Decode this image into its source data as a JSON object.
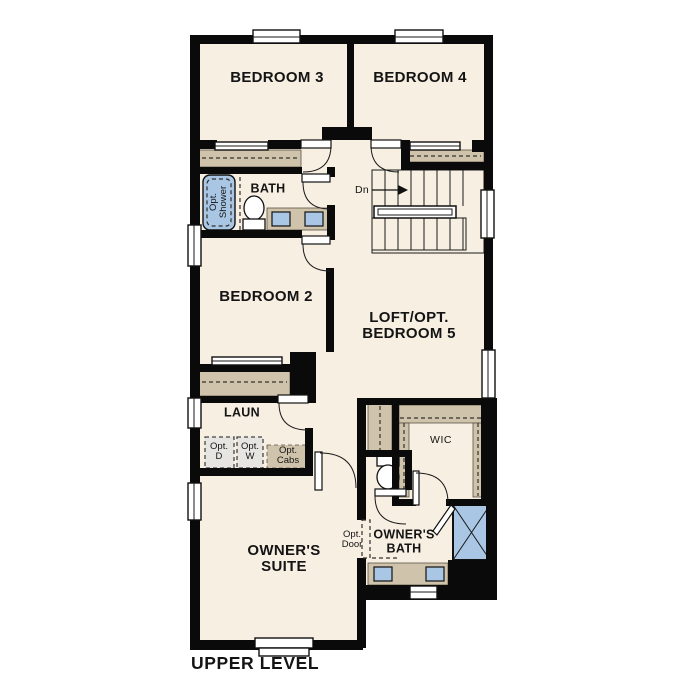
{
  "plan": {
    "level_label": "UPPER LEVEL",
    "rooms": {
      "bedroom3": {
        "label": "BEDROOM 3"
      },
      "bedroom4": {
        "label": "BEDROOM 4"
      },
      "bedroom2": {
        "label": "BEDROOM 2"
      },
      "bath": {
        "label": "BATH"
      },
      "loft": {
        "label": "LOFT/OPT.",
        "label2": "BEDROOM 5"
      },
      "laundry": {
        "label": "LAUN"
      },
      "owners_suite": {
        "label": "OWNER'S",
        "label2": "SUITE"
      },
      "owners_bath": {
        "label": "OWNER'S",
        "label2": "BATH"
      },
      "wic": {
        "label": "WIC"
      }
    },
    "annotations": {
      "opt_shower": {
        "line1": "Opt.",
        "line2": "Shower"
      },
      "opt_dryer": {
        "line1": "Opt.",
        "line2": "D"
      },
      "opt_washer": {
        "line1": "Opt.",
        "line2": "W"
      },
      "opt_cabs": {
        "line1": "Opt.",
        "line2": "Cabs"
      },
      "opt_door": {
        "line1": "Opt.",
        "line2": "Door"
      },
      "stairs_down": {
        "label": "Dn"
      }
    },
    "colors": {
      "floor": "#f7efe2",
      "wall": "#0a0a0a",
      "tan": "#d0c3ab",
      "blue": "#a9c6e4",
      "gray": "#e6e5e1"
    }
  }
}
